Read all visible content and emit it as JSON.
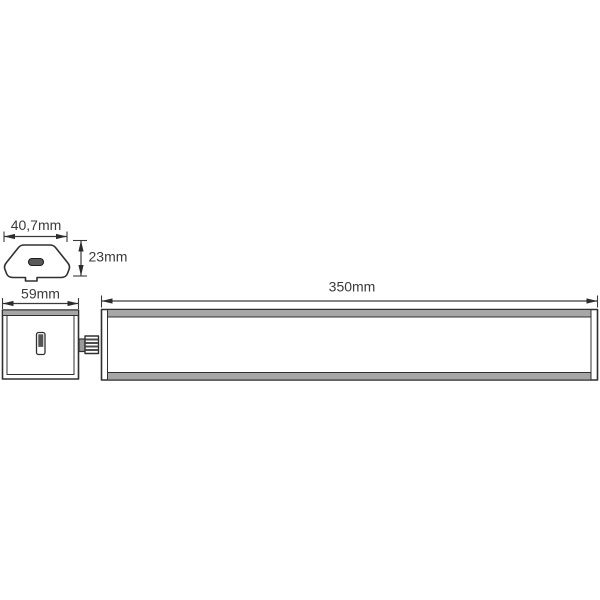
{
  "drawing": {
    "background": "#ffffff",
    "line_color": "#303030",
    "text_color": "#3a3a3a",
    "band_fill": "#a6a6a6",
    "cross_section": {
      "width_label": "40,7mm",
      "height_label": "23mm"
    },
    "front_view": {
      "driver_width_label": "59mm",
      "profile_length_label": "350mm"
    }
  }
}
